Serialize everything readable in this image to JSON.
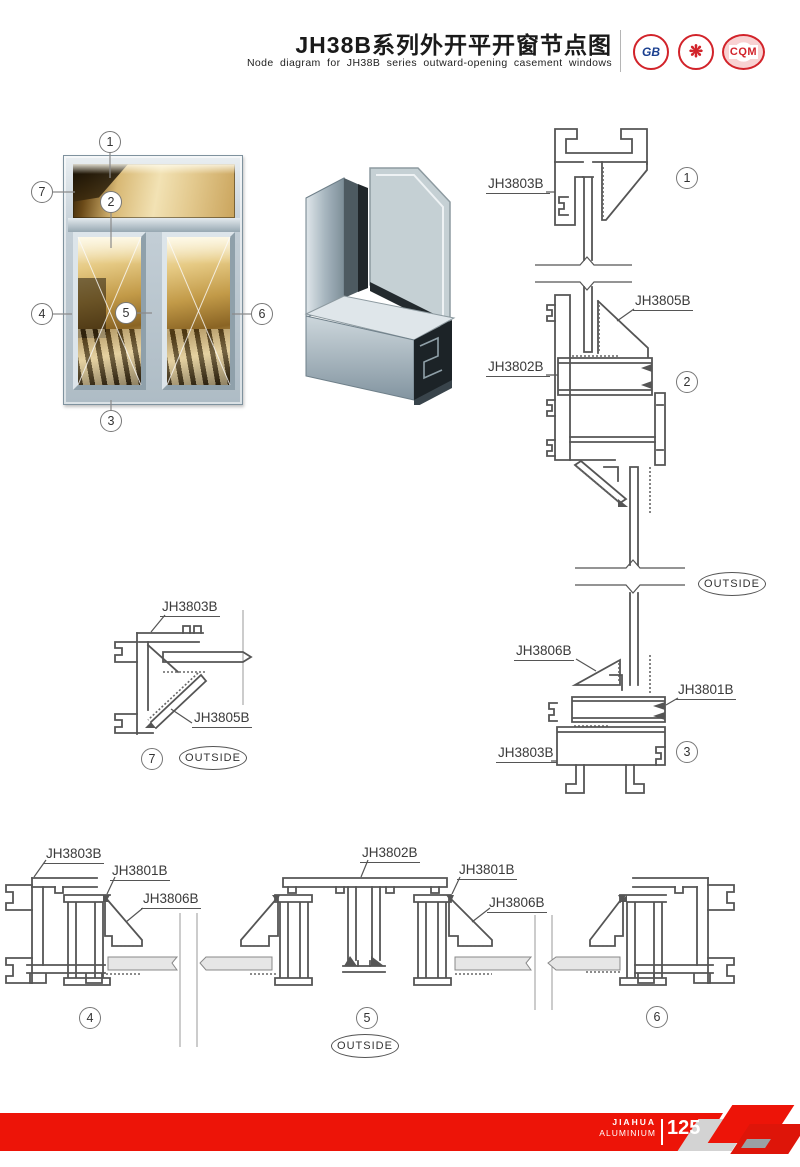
{
  "header": {
    "title_cn": "JH38B系列外开平开窗节点图",
    "title_en": "Node diagram for JH38B series outward-opening casement windows",
    "logos": [
      {
        "text": "GB"
      },
      {
        "text": "❋"
      },
      {
        "text": "CQM"
      }
    ]
  },
  "window": {
    "callouts": [
      "1",
      "2",
      "3",
      "4",
      "5",
      "6",
      "7"
    ]
  },
  "sections": {
    "s1": {
      "num": "1",
      "frame": "JH3803B"
    },
    "s2": {
      "num": "2",
      "bead": "JH3805B",
      "transom": "JH3802B"
    },
    "s3": {
      "num": "3",
      "bead": "JH3806B",
      "sash": "JH3801B",
      "frame": "JH3803B"
    },
    "s7": {
      "num": "7",
      "frame": "JH3803B",
      "bead": "JH3805B"
    },
    "s4": {
      "num": "4",
      "frame": "JH3803B",
      "sash": "JH3801B",
      "bead": "JH3806B"
    },
    "s5": {
      "num": "5",
      "transom": "JH3802B",
      "sash": "JH3801B",
      "bead": "JH3806B"
    },
    "s6": {
      "num": "6"
    }
  },
  "outside_label": "OUTSIDE",
  "footer": {
    "brand_top": "JIAHUA",
    "brand_bottom": "ALUMINIUM",
    "page_number": "125"
  },
  "colors": {
    "accent_red": "#ed1408",
    "drawing_line": "#555555"
  }
}
